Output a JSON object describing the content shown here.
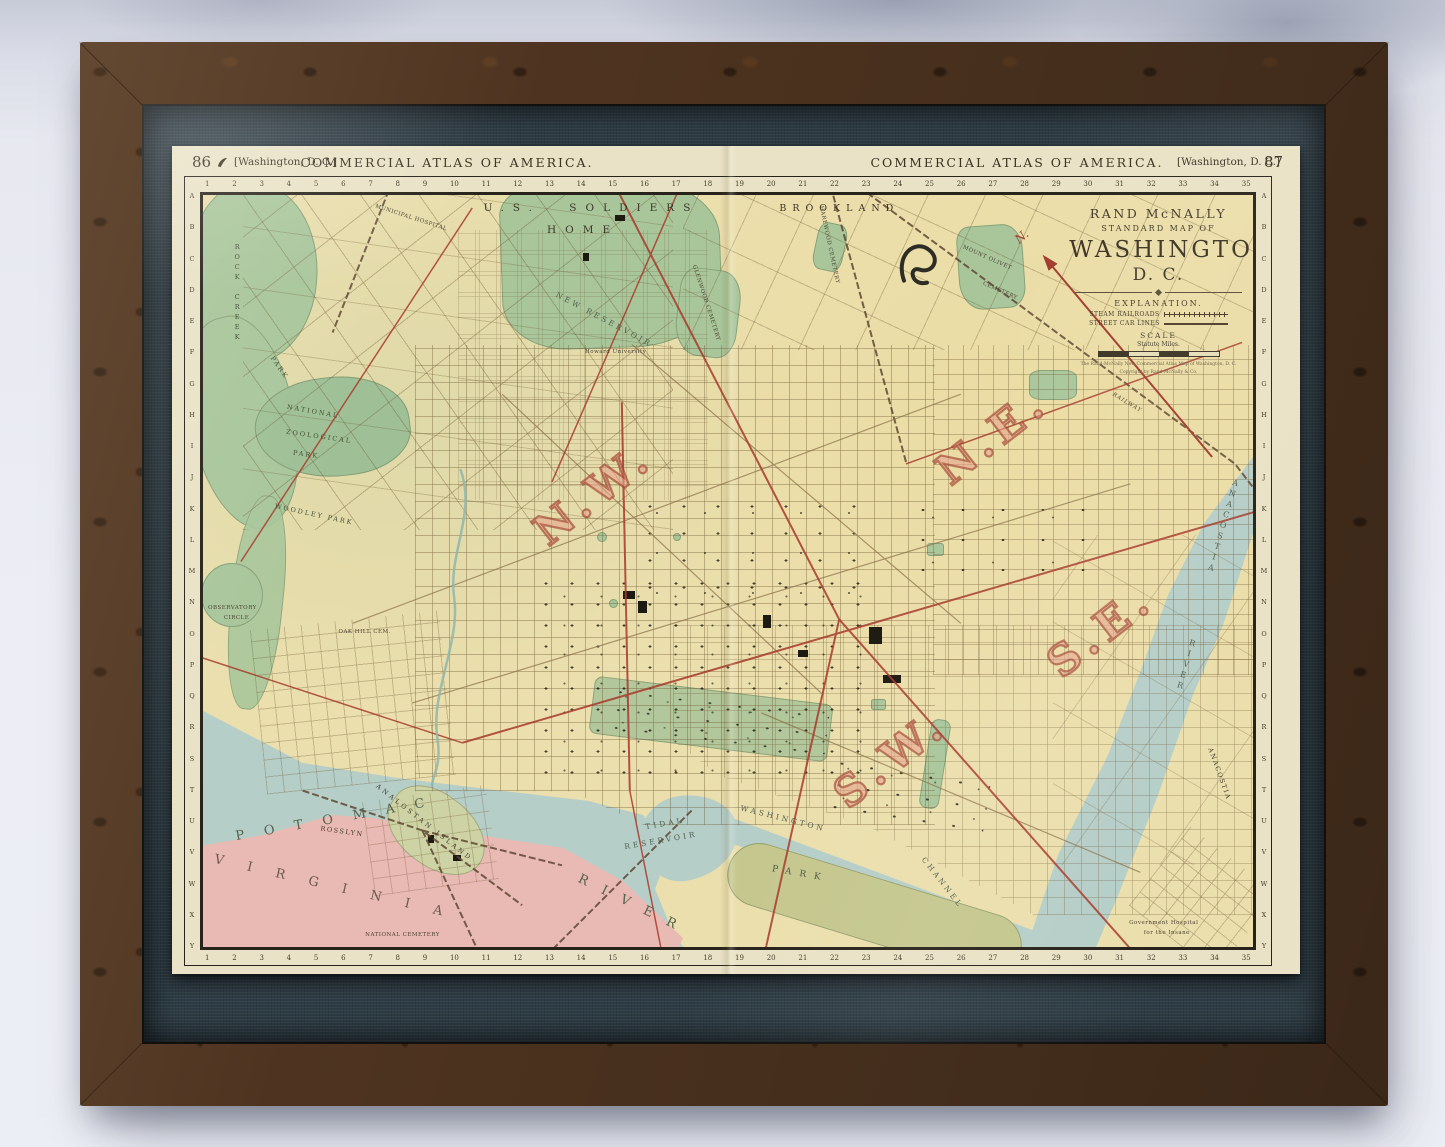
{
  "palette": {
    "map_base": "#ebdfad",
    "park_green": "#a9c69b",
    "water_blue": "#b6cec8",
    "virginia_pink": "#e9b9b3",
    "quadrant_red": "#a23b28",
    "streetcar_red": "#a83a2c",
    "mat_fabric": "#2e3d45",
    "frame_wood": "#4e3420",
    "paper_cream": "#e9e2c6"
  },
  "page_header": {
    "left_page_number": "86",
    "left_edition": "[Washington, D. C.]",
    "left_title": "COMMERCIAL ATLAS OF AMERICA.",
    "right_title": "COMMERCIAL ATLAS OF AMERICA.",
    "right_edition": "[Washington, D. C.]",
    "right_page_number": "87"
  },
  "title_block": {
    "publisher": "RAND McNALLY",
    "series": "STANDARD MAP OF",
    "title": "WASHINGTON",
    "subtitle": "D. C.",
    "explanation_heading": "EXPLANATION.",
    "legend_items": [
      {
        "label": "STEAM RAILROADS"
      },
      {
        "label": "STREET CAR LINES"
      }
    ],
    "scale_heading": "SCALE",
    "scale_units": "Statute Miles.",
    "imprint_line1": "The Rand-McNally New Commercial Atlas Map of Washington, D. C.",
    "imprint_line2": "Copyright by Rand McNally & Co.",
    "compass_label": "N."
  },
  "map_grid": {
    "column_numbers": [
      "1",
      "2",
      "3",
      "4",
      "5",
      "6",
      "7",
      "8",
      "9",
      "10",
      "11",
      "12",
      "13",
      "14",
      "15",
      "16",
      "17",
      "18",
      "19",
      "20",
      "21",
      "22",
      "23",
      "24",
      "25",
      "26",
      "27",
      "28",
      "29",
      "30",
      "31",
      "32",
      "33",
      "34",
      "35"
    ],
    "row_letters": [
      "A",
      "B",
      "C",
      "D",
      "E",
      "F",
      "G",
      "H",
      "I",
      "J",
      "K",
      "L",
      "M",
      "N",
      "O",
      "P",
      "Q",
      "R",
      "S",
      "T",
      "U",
      "V",
      "W",
      "X",
      "Y"
    ]
  },
  "map_labels": [
    {
      "t": "N.W.",
      "x": 37.2,
      "y": 39.7,
      "r": -38,
      "c": "quad"
    },
    {
      "t": "N.E.",
      "x": 75.2,
      "y": 32.1,
      "r": -38,
      "c": "quad"
    },
    {
      "t": "S.E.",
      "x": 85.5,
      "y": 58.0,
      "r": -38,
      "c": "quad"
    },
    {
      "t": "S.W.",
      "x": 65.5,
      "y": 75.0,
      "r": -38,
      "c": "quad"
    },
    {
      "t": "U.S. SOLDIERS",
      "x": 37.0,
      "y": 1.8,
      "r": 0,
      "c": "spread"
    },
    {
      "t": "HOME",
      "x": 36.2,
      "y": 4.8,
      "r": 0,
      "c": "spread"
    },
    {
      "t": "BROOKLAND",
      "x": 60.6,
      "y": 1.9,
      "r": 0,
      "c": "spread2"
    },
    {
      "t": "MUNICIPAL HOSPITAL",
      "x": 19.8,
      "y": 3.0,
      "r": 18,
      "c": "micro"
    },
    {
      "t": "ROCK CREEK",
      "x": 3.2,
      "y": 13.0,
      "r": 0,
      "c": "vert lpark"
    },
    {
      "t": "PARK",
      "x": 7.2,
      "y": 23.0,
      "r": 55,
      "c": "lpark"
    },
    {
      "t": "NATIONAL",
      "x": 10.5,
      "y": 28.8,
      "r": 10,
      "c": "lpark"
    },
    {
      "t": "ZOOLOGICAL",
      "x": 11.0,
      "y": 32.2,
      "r": 8,
      "c": "lpark"
    },
    {
      "t": "PARK",
      "x": 9.8,
      "y": 34.6,
      "r": 8,
      "c": "lpark"
    },
    {
      "t": "WOODLEY PARK",
      "x": 10.6,
      "y": 42.5,
      "r": 12,
      "c": "lpark"
    },
    {
      "t": "OBSERVATORY",
      "x": 2.8,
      "y": 54.9,
      "r": 0,
      "c": "micro"
    },
    {
      "t": "CIRCLE",
      "x": 3.2,
      "y": 56.2,
      "r": 0,
      "c": "micro"
    },
    {
      "t": "OAK HILL CEM.",
      "x": 15.4,
      "y": 58.1,
      "r": 0,
      "c": "micro"
    },
    {
      "t": "NEW RESERVOIR",
      "x": 38.2,
      "y": 16.6,
      "r": 28,
      "c": "hydro-sm"
    },
    {
      "t": "Howard University",
      "x": 39.3,
      "y": 20.9,
      "r": 0,
      "c": "micro"
    },
    {
      "t": "GLENWOOD CEMETERY",
      "x": 47.9,
      "y": 14.4,
      "r": 72,
      "c": "micro"
    },
    {
      "t": "HAREWOOD CEMETERY",
      "x": 59.6,
      "y": 6.6,
      "r": 78,
      "c": "micro"
    },
    {
      "t": "MOUNT OLIVET",
      "x": 74.7,
      "y": 8.4,
      "r": 24,
      "c": "micro"
    },
    {
      "t": "CEMETERY",
      "x": 75.9,
      "y": 12.8,
      "r": 24,
      "c": "micro"
    },
    {
      "t": "RAILWAY",
      "x": 88.0,
      "y": 27.6,
      "r": 31,
      "c": "microi"
    },
    {
      "t": "TIDAL",
      "x": 44.0,
      "y": 83.7,
      "r": -10,
      "c": "hydro-sm"
    },
    {
      "t": "RESERVOIR",
      "x": 43.6,
      "y": 85.9,
      "r": -10,
      "c": "hydro-sm"
    },
    {
      "t": "WASHINGTON",
      "x": 55.2,
      "y": 83.0,
      "r": 14,
      "c": "hydro-sm"
    },
    {
      "t": "PARK",
      "x": 56.9,
      "y": 90.4,
      "r": 10,
      "c": "hydro"
    },
    {
      "t": "CHANNEL",
      "x": 70.4,
      "y": 91.5,
      "r": 52,
      "c": "hydro-sm"
    },
    {
      "t": "POTOMAC",
      "x": 13.0,
      "y": 83.0,
      "r": -10,
      "c": "hydro-lg",
      "ls": 20
    },
    {
      "t": "RIVER",
      "x": 41.0,
      "y": 94.6,
      "r": 26,
      "c": "hydro-lg",
      "ls": 16
    },
    {
      "t": "VIRGINIA",
      "x": 13.0,
      "y": 92.3,
      "r": 13,
      "c": "land-lg",
      "ls": 24
    },
    {
      "t": "ROSSLYN",
      "x": 13.2,
      "y": 84.7,
      "r": 8,
      "c": "tinyl"
    },
    {
      "t": "ANALOSTAN ISLAND",
      "x": 21.0,
      "y": 83.5,
      "r": 38,
      "c": "tinyl",
      "ls": 3
    },
    {
      "t": "ANACOSTIA",
      "x": 97.0,
      "y": 44.0,
      "r": 16,
      "c": "vert hydro-v"
    },
    {
      "t": "RIVER",
      "x": 93.5,
      "y": 62.5,
      "r": 16,
      "c": "vert hydro-v"
    },
    {
      "t": "ANACOSTIA",
      "x": 96.8,
      "y": 77.0,
      "r": 70,
      "c": "tinyl"
    },
    {
      "t": "Government Hospital",
      "x": 91.5,
      "y": 96.8,
      "r": 0,
      "c": "micro"
    },
    {
      "t": "for the Insane",
      "x": 91.8,
      "y": 98.2,
      "r": 0,
      "c": "micro"
    },
    {
      "t": "NATIONAL CEMETERY",
      "x": 19.0,
      "y": 98.4,
      "r": 0,
      "c": "micro"
    },
    {
      "t": "N.",
      "x": 78.0,
      "y": 5.6,
      "r": -40,
      "c": "compass-n"
    }
  ]
}
